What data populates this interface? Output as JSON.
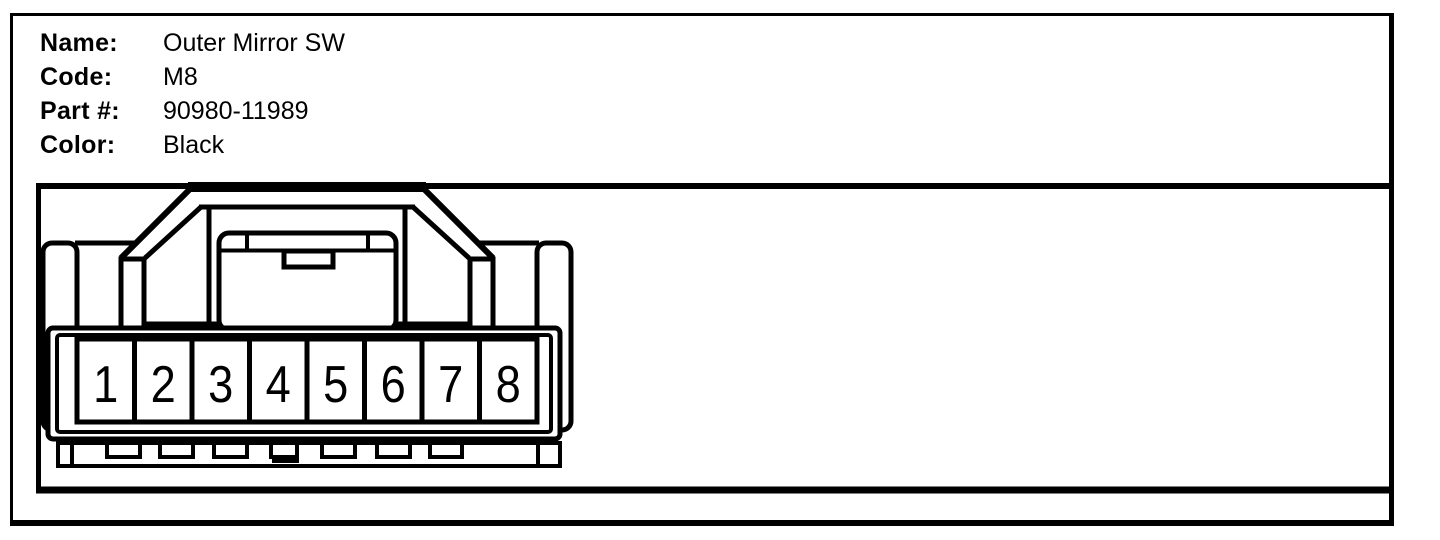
{
  "window": {
    "background": "#ffffff",
    "line_color": "#000000",
    "fill_color": "#ffffff"
  },
  "info_panel": {
    "fields": [
      {
        "label": "Name:",
        "value": "Outer Mirror SW"
      },
      {
        "label": "Code:",
        "value": "M8"
      },
      {
        "label": "Part #:",
        "value": "90980-11989"
      },
      {
        "label": "Color:",
        "value": "Black"
      }
    ]
  },
  "diagram": {
    "description": "8-pin connector front view line drawing",
    "pins": [
      "1",
      "2",
      "3",
      "4",
      "5",
      "6",
      "7",
      "8"
    ]
  }
}
